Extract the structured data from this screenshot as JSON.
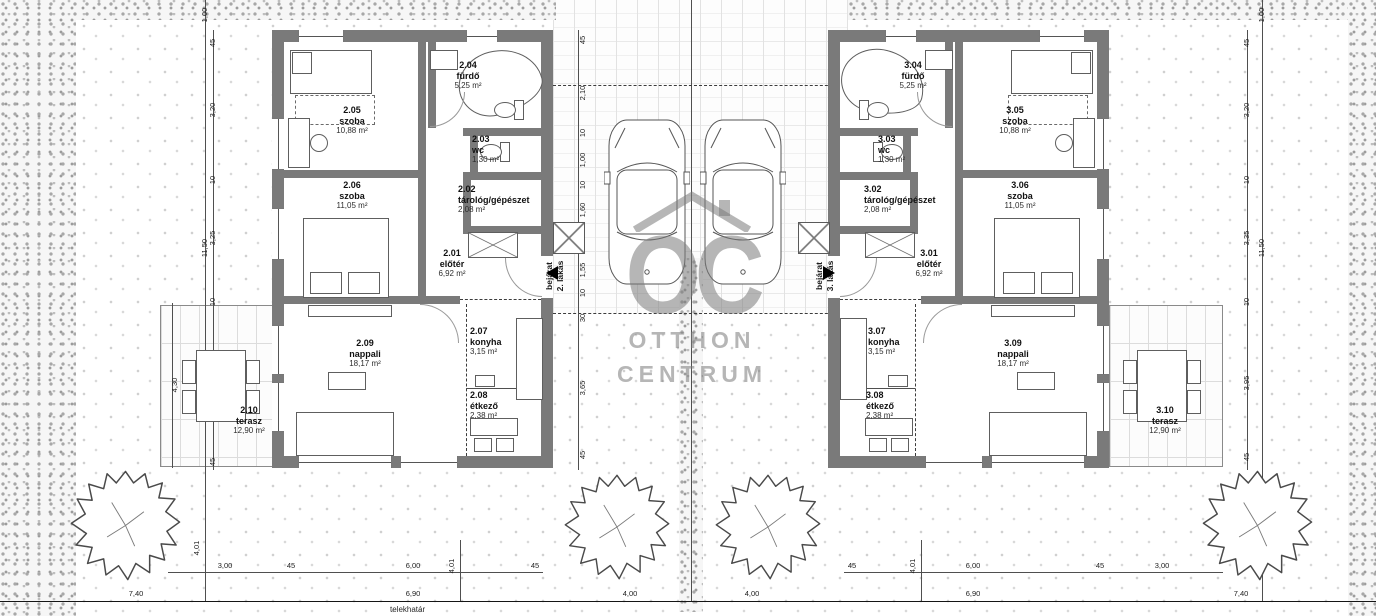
{
  "watermark": {
    "logo": "OC",
    "brand_line1": "OTTHON",
    "brand_line2": "CENTRUM"
  },
  "site": {
    "boundary_label": "telekhatár"
  },
  "houses": [
    {
      "side": "left",
      "entrance": {
        "line1": "bejárat",
        "line2": "2. lakás"
      },
      "rooms": [
        {
          "num": "2.01",
          "name": "előtér",
          "area": "6,92 m²"
        },
        {
          "num": "2.02",
          "name": "tárológ/gépészet",
          "area": "2,08 m²"
        },
        {
          "num": "2.03",
          "name": "wc",
          "area": "1,30 m²"
        },
        {
          "num": "2.04",
          "name": "fürdő",
          "area": "5,25 m²"
        },
        {
          "num": "2.05",
          "name": "szoba",
          "area": "10,88 m²"
        },
        {
          "num": "2.06",
          "name": "szoba",
          "area": "11,05 m²"
        },
        {
          "num": "2.07",
          "name": "konyha",
          "area": "3,15 m²"
        },
        {
          "num": "2.08",
          "name": "étkező",
          "area": "2,38 m²"
        },
        {
          "num": "2.09",
          "name": "nappali",
          "area": "18,17 m²"
        },
        {
          "num": "2.10",
          "name": "terasz",
          "area": "12,90 m²"
        }
      ]
    },
    {
      "side": "right",
      "entrance": {
        "line1": "bejárat",
        "line2": "3. lakás"
      },
      "rooms": [
        {
          "num": "3.01",
          "name": "előtér",
          "area": "6,92 m²"
        },
        {
          "num": "3.02",
          "name": "tárológ/gépészet",
          "area": "2,08 m²"
        },
        {
          "num": "3.03",
          "name": "wc",
          "area": "1,30 m²"
        },
        {
          "num": "3.04",
          "name": "fürdő",
          "area": "5,25 m²"
        },
        {
          "num": "3.05",
          "name": "szoba",
          "area": "10,88 m²"
        },
        {
          "num": "3.06",
          "name": "szoba",
          "area": "11,05 m²"
        },
        {
          "num": "3.07",
          "name": "konyha",
          "area": "3,15 m²"
        },
        {
          "num": "3.08",
          "name": "étkező",
          "area": "2,38 m²"
        },
        {
          "num": "3.09",
          "name": "nappali",
          "area": "18,17 m²"
        },
        {
          "num": "3.10",
          "name": "terasz",
          "area": "12,90 m²"
        }
      ]
    }
  ],
  "dims": {
    "center_chain": [
      "45",
      "2,10",
      "10",
      "1,00",
      "10",
      "1,60",
      "10",
      "1,55",
      "10",
      "30",
      "3,65",
      "45"
    ],
    "left_chain": [
      "45",
      "3,20",
      "10",
      "3,25",
      "10",
      "3,95",
      "45"
    ],
    "right_chain": [
      "45",
      "3,20",
      "10",
      "3,35",
      "10",
      "3,95",
      "45"
    ],
    "left_top": "1,00",
    "left_total": "11,50",
    "right_top": "1,00",
    "right_total": "11,50",
    "terrace_width": "4,30",
    "bottom_left": [
      "3,00",
      "45",
      "6,00",
      "45"
    ],
    "bottom_right": [
      "45",
      "6,00",
      "45",
      "3,00"
    ],
    "bottom_row2": [
      "7,40",
      "6,90",
      "4,00",
      "4,00",
      "6,90",
      "7,40"
    ],
    "front_depth": "4,01",
    "boundary_label": "telekhatár"
  }
}
